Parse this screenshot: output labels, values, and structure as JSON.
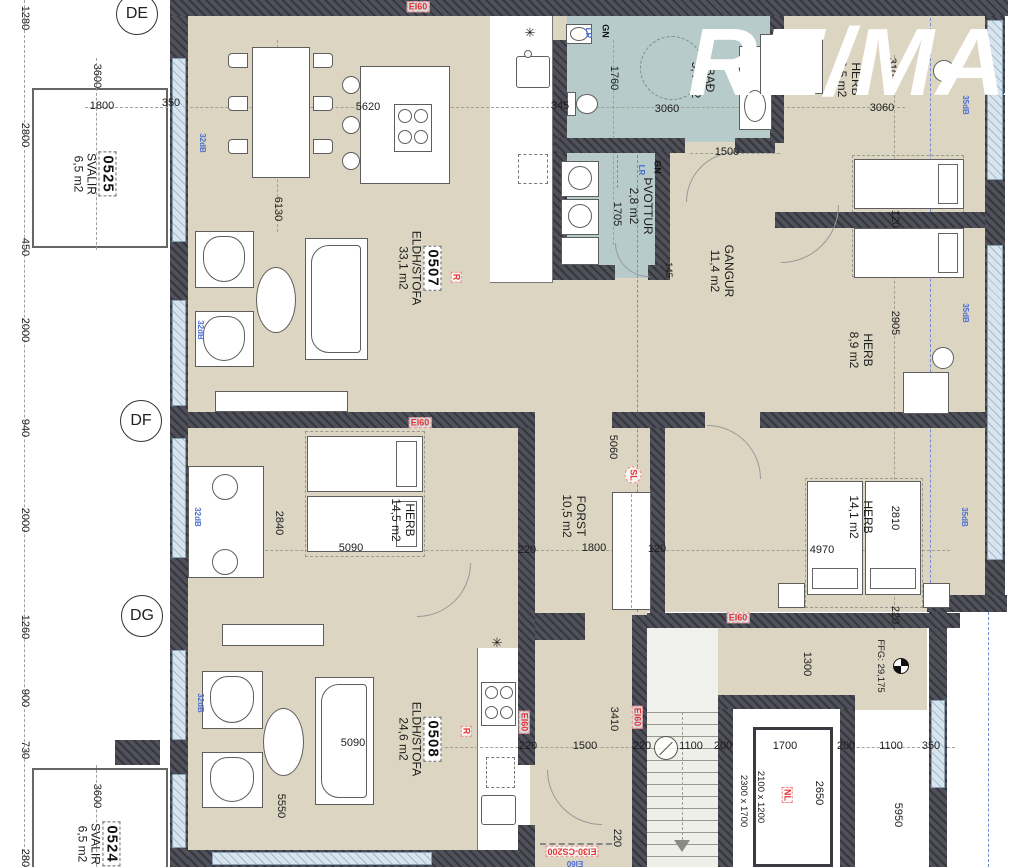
{
  "watermark": "RE/MAX",
  "grid_markers": [
    {
      "label": "DE",
      "x": 137,
      "y": 14
    },
    {
      "label": "DF",
      "x": 141,
      "y": 421
    },
    {
      "label": "DG",
      "x": 142,
      "y": 616
    }
  ],
  "room_labels": [
    {
      "id": "0525",
      "number": "0525",
      "lines": [
        "SVALIR",
        "6,5 m2"
      ],
      "x": 94,
      "y": 174
    },
    {
      "id": "0524",
      "number": "0524",
      "lines": [
        "SVALIR",
        "6,5 m2"
      ],
      "x": 98,
      "y": 844
    },
    {
      "id": "0507",
      "number": "0507",
      "lines": [
        "ELDH/STOFA",
        "33,1 m2"
      ],
      "x": 419,
      "y": 268
    },
    {
      "id": "0508",
      "number": "0508",
      "lines": [
        "ELDH/STOFA",
        "24,6 m2"
      ],
      "x": 419,
      "y": 739
    },
    {
      "id": "bad",
      "lines": [
        "BAÐ",
        "5,4 m2"
      ],
      "x": 703,
      "y": 80
    },
    {
      "id": "thvottur",
      "lines": [
        "ÞVOTTUR",
        "2,8 m2"
      ],
      "x": 641,
      "y": 206
    },
    {
      "id": "gangur",
      "lines": [
        "GANGUR",
        "11,4 m2"
      ],
      "x": 722,
      "y": 271
    },
    {
      "id": "herb-95",
      "lines": [
        "HERB",
        "9,5 m2"
      ],
      "x": 849,
      "y": 79
    },
    {
      "id": "herb-89",
      "lines": [
        "HERB",
        "8,9 m2"
      ],
      "x": 861,
      "y": 350
    },
    {
      "id": "herb-145",
      "lines": [
        "HERB",
        "14,5 m2"
      ],
      "x": 403,
      "y": 520
    },
    {
      "id": "herb-141",
      "lines": [
        "HERB",
        "14,1 m2"
      ],
      "x": 861,
      "y": 517
    },
    {
      "id": "forst",
      "lines": [
        "FORST",
        "10,5 m2"
      ],
      "x": 574,
      "y": 516
    }
  ],
  "annotations": [
    {
      "n": "dim-1800-balcony",
      "t": "1800",
      "x": 102,
      "y": 107,
      "r": 0,
      "c": "dim"
    },
    {
      "n": "dim-350-top",
      "t": "350",
      "x": 171,
      "y": 104,
      "r": 0,
      "c": "dim"
    },
    {
      "n": "dim-5620",
      "t": "5620",
      "x": 368,
      "y": 108,
      "r": 0,
      "c": "dim"
    },
    {
      "n": "dim-345",
      "t": "345",
      "x": 560,
      "y": 107,
      "r": 0,
      "c": "dim"
    },
    {
      "n": "dim-3060-bad",
      "t": "3060",
      "x": 667,
      "y": 110,
      "r": 0,
      "c": "dim"
    },
    {
      "n": "dim-1500-bad",
      "t": "1500",
      "x": 727,
      "y": 153,
      "r": 0,
      "c": "dim"
    },
    {
      "n": "dim-3060-herb",
      "t": "3060",
      "x": 882,
      "y": 109,
      "r": 0,
      "c": "dim"
    },
    {
      "n": "dim-5090-herb145",
      "t": "5090",
      "x": 351,
      "y": 549,
      "r": 0,
      "c": "dim"
    },
    {
      "n": "dim-220-forst",
      "t": "220",
      "x": 527,
      "y": 551,
      "r": 0,
      "c": "dim"
    },
    {
      "n": "dim-1800-forst",
      "t": "1800",
      "x": 594,
      "y": 549,
      "r": 0,
      "c": "dim"
    },
    {
      "n": "dim-120-forst",
      "t": "120",
      "x": 657,
      "y": 550,
      "r": 0,
      "c": "dim"
    },
    {
      "n": "dim-4970",
      "t": "4970",
      "x": 822,
      "y": 551,
      "r": 0,
      "c": "dim"
    },
    {
      "n": "dim-5090-0508",
      "t": "5090",
      "x": 353,
      "y": 744,
      "r": 0,
      "c": "dim"
    },
    {
      "n": "dim-220-a",
      "t": "220",
      "x": 528,
      "y": 747,
      "r": 0,
      "c": "dim"
    },
    {
      "n": "dim-1500-hall",
      "t": "1500",
      "x": 585,
      "y": 747,
      "r": 0,
      "c": "dim"
    },
    {
      "n": "dim-220-b",
      "t": "220",
      "x": 642,
      "y": 747,
      "r": 0,
      "c": "dim"
    },
    {
      "n": "dim-1100-a",
      "t": "1100",
      "x": 691,
      "y": 747,
      "r": 0,
      "c": "dim"
    },
    {
      "n": "dim-200-a",
      "t": "200",
      "x": 723,
      "y": 747,
      "r": 0,
      "c": "dim"
    },
    {
      "n": "dim-1700",
      "t": "1700",
      "x": 785,
      "y": 747,
      "r": 0,
      "c": "dim"
    },
    {
      "n": "dim-200-b",
      "t": "200",
      "x": 846,
      "y": 747,
      "r": 0,
      "c": "dim"
    },
    {
      "n": "dim-1100-b",
      "t": "1100",
      "x": 891,
      "y": 747,
      "r": 0,
      "c": "dim"
    },
    {
      "n": "dim-350-bottom",
      "t": "350",
      "x": 931,
      "y": 747,
      "r": 0,
      "c": "dim"
    },
    {
      "n": "dim-1280",
      "t": "1280",
      "x": 24,
      "y": 18,
      "r": 90,
      "c": "dim"
    },
    {
      "n": "dim-2800-top",
      "t": "2800",
      "x": 24,
      "y": 135,
      "r": 90,
      "c": "dim"
    },
    {
      "n": "dim-450",
      "t": "450",
      "x": 24,
      "y": 247,
      "r": 90,
      "c": "dim"
    },
    {
      "n": "dim-2000-a",
      "t": "2000",
      "x": 24,
      "y": 330,
      "r": 90,
      "c": "dim"
    },
    {
      "n": "dim-940",
      "t": "940",
      "x": 24,
      "y": 428,
      "r": 90,
      "c": "dim"
    },
    {
      "n": "dim-2000-b",
      "t": "2000",
      "x": 24,
      "y": 520,
      "r": 90,
      "c": "dim"
    },
    {
      "n": "dim-1260",
      "t": "1260",
      "x": 24,
      "y": 627,
      "r": 90,
      "c": "dim"
    },
    {
      "n": "dim-900",
      "t": "900",
      "x": 24,
      "y": 698,
      "r": 90,
      "c": "dim"
    },
    {
      "n": "dim-730",
      "t": "730",
      "x": 24,
      "y": 750,
      "r": 90,
      "c": "dim"
    },
    {
      "n": "dim-2800-bottom",
      "t": "2800",
      "x": 24,
      "y": 861,
      "r": 90,
      "c": "dim"
    },
    {
      "n": "dim-3600-top",
      "t": "3600",
      "x": 96,
      "y": 76,
      "r": 90,
      "c": "dim"
    },
    {
      "n": "dim-3600-bottom",
      "t": "3600",
      "x": 96,
      "y": 796,
      "r": 90,
      "c": "dim"
    },
    {
      "n": "dim-1760",
      "t": "1760",
      "x": 613,
      "y": 78,
      "r": 90,
      "c": "dim"
    },
    {
      "n": "dim-3105",
      "t": "3105",
      "x": 891,
      "y": 70,
      "r": 90,
      "c": "dim"
    },
    {
      "n": "dim-6130",
      "t": "6130",
      "x": 277,
      "y": 209,
      "r": 90,
      "c": "dim"
    },
    {
      "n": "dim-1705",
      "t": "1705",
      "x": 616,
      "y": 214,
      "r": 90,
      "c": "dim"
    },
    {
      "n": "dim-145",
      "t": "145",
      "x": 668,
      "y": 270,
      "r": 90,
      "c": "dimsm"
    },
    {
      "n": "dim-120-beds",
      "t": "120",
      "x": 894,
      "y": 219,
      "r": 90,
      "c": "dim"
    },
    {
      "n": "dim-2905",
      "t": "2905",
      "x": 894,
      "y": 323,
      "r": 90,
      "c": "dim"
    },
    {
      "n": "dim-2840",
      "t": "2840",
      "x": 278,
      "y": 523,
      "r": 90,
      "c": "dim"
    },
    {
      "n": "dim-5060",
      "t": "5060",
      "x": 612,
      "y": 447,
      "r": 90,
      "c": "dim"
    },
    {
      "n": "dim-2810",
      "t": "2810",
      "x": 894,
      "y": 518,
      "r": 90,
      "c": "dim"
    },
    {
      "n": "dim-220-herb141",
      "t": "220",
      "x": 894,
      "y": 615,
      "r": 90,
      "c": "dim"
    },
    {
      "n": "dim-5550",
      "t": "5550",
      "x": 280,
      "y": 806,
      "r": 90,
      "c": "dim"
    },
    {
      "n": "dim-3410",
      "t": "3410",
      "x": 613,
      "y": 719,
      "r": 90,
      "c": "dim"
    },
    {
      "n": "dim-1300",
      "t": "1300",
      "x": 806,
      "y": 664,
      "r": 90,
      "c": "dim"
    },
    {
      "n": "dim-2650",
      "t": "2650",
      "x": 818,
      "y": 793,
      "r": 90,
      "c": "dim"
    },
    {
      "n": "dim-5950",
      "t": "5950",
      "x": 897,
      "y": 815,
      "r": 90,
      "c": "dim"
    },
    {
      "n": "dim-220-hall",
      "t": "220",
      "x": 616,
      "y": 838,
      "r": 90,
      "c": "dim"
    },
    {
      "n": "dim-lift-car",
      "t": "2100 x 1200",
      "x": 760,
      "y": 797,
      "r": 90,
      "c": "dimsm"
    },
    {
      "n": "dim-lift-shaft",
      "t": "2300 x 1700",
      "x": 743,
      "y": 801,
      "r": 90,
      "c": "dimsm"
    },
    {
      "n": "label-ffg-level",
      "t": "FFG: 29,175",
      "x": 880,
      "y": 666,
      "r": 90,
      "c": "dimsm"
    },
    {
      "n": "fire-ei60-top",
      "t": "EI60",
      "x": 418,
      "y": 7,
      "r": 0,
      "c": "fire"
    },
    {
      "n": "fire-ei60-mid",
      "t": "EI60",
      "x": 420,
      "y": 423,
      "r": 0,
      "c": "fire"
    },
    {
      "n": "fire-ei60-stair",
      "t": "EI60",
      "x": 738,
      "y": 618,
      "r": 0,
      "c": "fire"
    },
    {
      "n": "fire-ei60-hall-left",
      "t": "EI60",
      "x": 524,
      "y": 722,
      "r": 90,
      "c": "fire"
    },
    {
      "n": "fire-ei60-hall-right",
      "t": "EI60",
      "x": 637,
      "y": 717,
      "r": 90,
      "c": "fire"
    },
    {
      "n": "fire-door-ei30",
      "t": "EI30-CS200",
      "x": 572,
      "y": 851,
      "r": 180,
      "c": "fire"
    },
    {
      "n": "label-nl",
      "t": "NL",
      "x": 787,
      "y": 795,
      "r": 90,
      "c": "fire"
    },
    {
      "n": "label-r-0507",
      "t": "R",
      "x": 456,
      "y": 277,
      "r": 90,
      "c": "fire"
    },
    {
      "n": "label-r-0508",
      "t": "R",
      "x": 466,
      "y": 731,
      "r": 90,
      "c": "fire"
    },
    {
      "n": "label-sl",
      "t": "SL",
      "x": 633,
      "y": 475,
      "r": 90,
      "c": "firec"
    },
    {
      "n": "label-lr-top",
      "t": "LR",
      "x": 588,
      "y": 33,
      "r": 90,
      "c": "blue"
    },
    {
      "n": "label-lr-mid",
      "t": "LR",
      "x": 641,
      "y": 170,
      "r": 90,
      "c": "blue"
    },
    {
      "n": "label-gn-top",
      "t": "GN",
      "x": 605,
      "y": 31,
      "r": 90,
      "c": "gn"
    },
    {
      "n": "label-gn-mid",
      "t": "GN",
      "x": 657,
      "y": 167,
      "r": 90,
      "c": "gn"
    },
    {
      "n": "acoustic-32db-a",
      "t": "32dB",
      "x": 202,
      "y": 143,
      "r": 90,
      "c": "blue"
    },
    {
      "n": "acoustic-32db-b",
      "t": "32dB",
      "x": 200,
      "y": 330,
      "r": 90,
      "c": "blue"
    },
    {
      "n": "acoustic-32db-c",
      "t": "32dB",
      "x": 197,
      "y": 517,
      "r": 90,
      "c": "blue"
    },
    {
      "n": "acoustic-32db-d",
      "t": "32dB",
      "x": 200,
      "y": 703,
      "r": 90,
      "c": "blue"
    },
    {
      "n": "acoustic-35db-a",
      "t": "35dB",
      "x": 965,
      "y": 105,
      "r": 90,
      "c": "blue"
    },
    {
      "n": "acoustic-35db-b",
      "t": "35dB",
      "x": 965,
      "y": 313,
      "r": 90,
      "c": "blue"
    },
    {
      "n": "acoustic-35db-c",
      "t": "35dB",
      "x": 964,
      "y": 517,
      "r": 90,
      "c": "blue"
    },
    {
      "n": "label-ei60-blue",
      "t": "EI60",
      "x": 575,
      "y": 863,
      "r": 180,
      "c": "blue"
    },
    {
      "n": "fixture-star-kitchen-0507",
      "t": "✳",
      "x": 530,
      "y": 33,
      "r": 0,
      "c": "sym"
    },
    {
      "n": "fixture-star-kitchen-0508",
      "t": "✳",
      "x": 497,
      "y": 643,
      "r": 0,
      "c": "sym"
    }
  ]
}
